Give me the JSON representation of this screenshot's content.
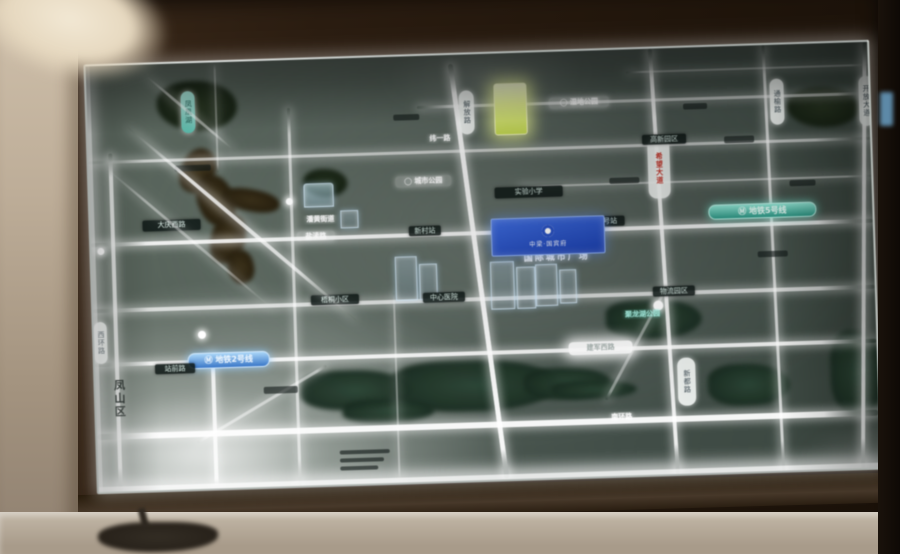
{
  "board": {
    "plaque": {
      "logo_name": "developer-ring-logo",
      "text": "中梁·国宾府"
    },
    "caption": "国际城市广场",
    "metro_badges": [
      {
        "name": "metro-line5-badge",
        "text": "Ⓜ 地铁5号线"
      },
      {
        "name": "metro-line2-badge",
        "text": "Ⓜ 地铁2号线"
      }
    ],
    "district_label": "凤山区",
    "features": [
      {
        "t": "wa",
        "n": "lake-northwest",
        "x": 36,
        "y": 2,
        "w": 146,
        "h": 88
      },
      {
        "t": "bl",
        "n": "lake-inner-patch",
        "x": 70,
        "y": 18,
        "w": 80,
        "h": 50
      },
      {
        "t": "riv",
        "n": "river-bend-1",
        "x": 92,
        "y": 85,
        "w": 34,
        "h": 46,
        "rot": 28
      },
      {
        "t": "riv",
        "n": "river-bend-2",
        "x": 108,
        "y": 112,
        "w": 36,
        "h": 52,
        "rot": -20
      },
      {
        "t": "riv",
        "n": "river-arm",
        "x": 132,
        "y": 128,
        "w": 58,
        "h": 22,
        "rot": 12
      },
      {
        "t": "riv",
        "n": "river-bend-3",
        "x": 120,
        "y": 152,
        "w": 34,
        "h": 50,
        "rot": 18
      },
      {
        "t": "riv",
        "n": "river-tail",
        "x": 136,
        "y": 188,
        "w": 26,
        "h": 34,
        "rot": -12
      },
      {
        "t": "wa",
        "n": "canal-west-1",
        "x": 24,
        "y": 198,
        "w": 56,
        "h": 34
      },
      {
        "t": "wa",
        "n": "canal-west-2",
        "x": 104,
        "y": 226,
        "w": 58,
        "h": 36
      },
      {
        "t": "wa2",
        "n": "river-south-1",
        "x": 204,
        "y": 312,
        "w": 112,
        "h": 40
      },
      {
        "t": "wa2",
        "n": "river-south-2",
        "x": 295,
        "y": 305,
        "w": 168,
        "h": 52
      },
      {
        "t": "wa2",
        "n": "river-south-3",
        "x": 428,
        "y": 316,
        "w": 88,
        "h": 32
      },
      {
        "t": "wa2",
        "n": "river-south-4",
        "x": 455,
        "y": 330,
        "w": 86,
        "h": 18
      },
      {
        "t": "wa2",
        "n": "river-south-5",
        "x": 246,
        "y": 342,
        "w": 92,
        "h": 24
      },
      {
        "t": "wa2",
        "n": "lake-east",
        "x": 512,
        "y": 250,
        "w": 96,
        "h": 40
      },
      {
        "t": "wa2",
        "n": "river-southeast",
        "x": 612,
        "y": 318,
        "w": 82,
        "h": 42
      },
      {
        "t": "wa2",
        "n": "river-east-edge",
        "x": 735,
        "y": 288,
        "w": 55,
        "h": 84
      },
      {
        "t": "bl",
        "n": "park-trees-northeast",
        "x": 700,
        "y": 44,
        "w": 72,
        "h": 40
      },
      {
        "t": "bl",
        "n": "park-patch-center",
        "x": 214,
        "y": 110,
        "w": 44,
        "h": 28
      },
      {
        "t": "rh",
        "n": "road-h-north",
        "x": 0,
        "y": 95,
        "w": 782,
        "h": 3,
        "op": 0.7
      },
      {
        "t": "rh",
        "n": "road-h-main",
        "x": 0,
        "y": 177,
        "w": 782,
        "h": 4,
        "op": 0.95
      },
      {
        "t": "rh",
        "n": "road-h-mid",
        "x": 0,
        "y": 243,
        "w": 782,
        "h": 4,
        "op": 0.8
      },
      {
        "t": "rh",
        "n": "road-h-jianjun",
        "x": 0,
        "y": 297,
        "w": 782,
        "h": 4,
        "op": 0.95
      },
      {
        "t": "rh",
        "n": "road-h-south",
        "x": 0,
        "y": 368,
        "w": 782,
        "h": 6,
        "op": 1
      },
      {
        "t": "rh",
        "n": "road-h-top-east",
        "x": 330,
        "y": 50,
        "w": 452,
        "h": 3,
        "op": 0.65
      },
      {
        "t": "rh",
        "n": "road-h-east-minor",
        "x": 430,
        "y": 133,
        "w": 352,
        "h": 2,
        "op": 0.55
      },
      {
        "t": "rh",
        "n": "road-h-top-edge",
        "x": 540,
        "y": 22,
        "w": 242,
        "h": 2,
        "op": 0.45
      },
      {
        "t": "rv",
        "n": "road-v-west",
        "x": 20,
        "y": 88,
        "w": 4,
        "h": 338,
        "op": 0.85
      },
      {
        "t": "rv",
        "n": "road-v-southwest",
        "x": 116,
        "y": 290,
        "w": 4,
        "h": 136,
        "op": 0.9
      },
      {
        "t": "rv",
        "n": "road-v-northwest-faint",
        "x": 128,
        "y": 0,
        "w": 2,
        "h": 110,
        "op": 0.4
      },
      {
        "t": "rv",
        "n": "road-v-left",
        "x": 200,
        "y": 48,
        "w": 3,
        "h": 378,
        "op": 0.7
      },
      {
        "t": "rv",
        "n": "road-v-center",
        "x": 384,
        "y": 8,
        "w": 5,
        "h": 418,
        "op": 1,
        "rot": -6
      },
      {
        "t": "rv",
        "n": "road-v-east-center",
        "x": 570,
        "y": 0,
        "w": 4,
        "h": 426,
        "op": 0.95,
        "rot": -2
      },
      {
        "t": "rv",
        "n": "road-v-east",
        "x": 680,
        "y": 0,
        "w": 3,
        "h": 426,
        "op": 0.8,
        "rot": -1
      },
      {
        "t": "rv",
        "n": "road-v-far-east",
        "x": 770,
        "y": 0,
        "w": 4,
        "h": 426,
        "op": 0.95,
        "rot": 2
      },
      {
        "t": "rv",
        "n": "road-v-minor",
        "x": 300,
        "y": 236,
        "w": 2,
        "h": 190,
        "op": 0.45
      },
      {
        "t": "rdg",
        "n": "road-diag-southwest",
        "x": 100,
        "y": 378,
        "w": 150,
        "h": 3,
        "rot": -29,
        "op": 0.6
      },
      {
        "t": "rdg",
        "n": "road-diag-southeast",
        "x": 510,
        "y": 348,
        "w": 135,
        "h": 3,
        "rot": -60,
        "op": 0.5
      },
      {
        "t": "bd",
        "n": "building-block-1",
        "x": 303,
        "y": 200,
        "w": 20,
        "h": 42
      },
      {
        "t": "bd",
        "n": "building-block-2",
        "x": 327,
        "y": 208,
        "w": 16,
        "h": 34
      },
      {
        "t": "bd",
        "n": "building-block-3",
        "x": 398,
        "y": 208,
        "w": 22,
        "h": 46
      },
      {
        "t": "bd",
        "n": "building-block-4",
        "x": 424,
        "y": 214,
        "w": 17,
        "h": 40
      },
      {
        "t": "bd",
        "n": "building-block-5",
        "x": 443,
        "y": 212,
        "w": 20,
        "h": 40
      },
      {
        "t": "bd",
        "n": "building-block-6",
        "x": 467,
        "y": 218,
        "w": 15,
        "h": 32
      },
      {
        "t": "bd",
        "n": "building-small",
        "x": 250,
        "y": 152,
        "w": 16,
        "h": 16
      },
      {
        "t": "bd",
        "n": "landmark-pale-building",
        "x": 214,
        "y": 124,
        "w": 28,
        "h": 22,
        "cls": "pale"
      },
      {
        "t": "vpill",
        "n": "lake-name-pill",
        "x": 94,
        "y": 28,
        "w": 14,
        "h": 42,
        "text": "凤凰湖",
        "cls": "teal"
      },
      {
        "t": "vdark",
        "n": "district-label",
        "x": 16,
        "y": 308,
        "w": 15,
        "h": 50,
        "text": "凤山区"
      },
      {
        "t": "tealbadge",
        "n": "metro-line5-badge",
        "x": 618,
        "y": 158,
        "w": 106,
        "h": 13,
        "text": "Ⓜ 地铁5号线"
      },
      {
        "t": "bluebadge",
        "n": "metro-line2-badge",
        "x": 93,
        "y": 290,
        "w": 80,
        "h": 14,
        "text": "Ⓜ 地铁2号线"
      },
      {
        "t": "caption",
        "n": "project-caption",
        "x": 402,
        "y": 200,
        "w": 126,
        "h": 12,
        "text": "国际城市广场"
      },
      {
        "t": "yellow",
        "n": "highlight-tower",
        "x": 407,
        "y": 30,
        "w": 31,
        "h": 50
      },
      {
        "t": "vpill",
        "n": "road-pill-red",
        "x": 559,
        "y": 90,
        "w": 22,
        "h": 60,
        "text": "希望大道",
        "cls": "red"
      },
      {
        "t": "vpill",
        "n": "road-pill-center",
        "x": 372,
        "y": 36,
        "w": 15,
        "h": 44,
        "text": "解放路"
      },
      {
        "t": "vpill",
        "n": "road-pill-tongyu",
        "x": 683,
        "y": 34,
        "w": 14,
        "h": 46,
        "text": "通榆路"
      },
      {
        "t": "vpill",
        "n": "road-pill-kaifang",
        "x": 772,
        "y": 34,
        "w": 14,
        "h": 50,
        "text": "开放大道"
      },
      {
        "t": "vpill",
        "n": "road-pill-xindu",
        "x": 582,
        "y": 310,
        "w": 18,
        "h": 48,
        "text": "新都路"
      },
      {
        "t": "vpill",
        "n": "road-pill-west",
        "x": 0,
        "y": 256,
        "w": 13,
        "h": 42,
        "text": "西环路"
      },
      {
        "t": "dk",
        "n": "poi-school",
        "x": 405,
        "y": 134,
        "w": 68,
        "h": 11,
        "text": "实验小学"
      },
      {
        "t": "gpill",
        "n": "road-label-yandu",
        "x": 206,
        "y": 172,
        "w": 38,
        "h": 10,
        "text": "盐渎路"
      },
      {
        "t": "dk",
        "n": "station-label-1",
        "x": 318,
        "y": 170,
        "w": 32,
        "h": 10,
        "text": "新村站"
      },
      {
        "t": "dk",
        "n": "station-label-2",
        "x": 498,
        "y": 166,
        "w": 36,
        "h": 10,
        "text": "一号站"
      },
      {
        "t": "gpill",
        "n": "poi-wetland-park",
        "x": 462,
        "y": 46,
        "w": 60,
        "h": 11,
        "text": "◯ 湿地公园"
      },
      {
        "t": "gpill",
        "n": "poi-city-park",
        "x": 306,
        "y": 120,
        "w": 56,
        "h": 11,
        "text": "◯ 城市公园"
      },
      {
        "t": "glow",
        "n": "road-label-weiyi",
        "x": 334,
        "y": 78,
        "w": 36,
        "h": 10,
        "text": "纬一路"
      },
      {
        "t": "tealtext",
        "n": "poi-lake-park",
        "x": 520,
        "y": 260,
        "w": 58,
        "h": 10,
        "text": "聚龙湖公园"
      },
      {
        "t": "hot",
        "n": "road-label-jianjun",
        "x": 474,
        "y": 291,
        "w": 64,
        "h": 13,
        "text": "建军西路"
      },
      {
        "t": "glow",
        "n": "road-label-south",
        "x": 502,
        "y": 362,
        "w": 46,
        "h": 11,
        "text": "南环路"
      },
      {
        "t": "dk",
        "n": "poi-block-1",
        "x": 218,
        "y": 236,
        "w": 48,
        "h": 10,
        "text": "梧桐小区"
      },
      {
        "t": "dk",
        "n": "poi-block-2",
        "x": 330,
        "y": 237,
        "w": 42,
        "h": 10,
        "text": "中心医院"
      },
      {
        "t": "glow",
        "n": "poi-street-office",
        "x": 208,
        "y": 156,
        "w": 44,
        "h": 9,
        "text": "潘黄街道"
      },
      {
        "t": "dk",
        "n": "poi-hightech",
        "x": 554,
        "y": 86,
        "w": 44,
        "h": 10,
        "text": "高新园区"
      },
      {
        "t": "dk",
        "n": "poi-logistics",
        "x": 560,
        "y": 238,
        "w": 42,
        "h": 10,
        "text": "物流园区"
      },
      {
        "t": "dk",
        "n": "road-label-daqing",
        "x": 52,
        "y": 156,
        "w": 58,
        "h": 11,
        "text": "大庆西路"
      },
      {
        "t": "dk",
        "n": "road-label-zhanqian",
        "x": 60,
        "y": 300,
        "w": 40,
        "h": 10,
        "text": "站前路"
      },
      {
        "t": "dot",
        "n": "station-dot-1",
        "x": 104,
        "y": 268,
        "w": 8,
        "h": 8
      },
      {
        "t": "dot",
        "n": "station-dot-2",
        "x": 6,
        "y": 182,
        "w": 7,
        "h": 7
      },
      {
        "t": "dot",
        "n": "station-dot-3",
        "x": 196,
        "y": 138,
        "w": 7,
        "h": 7
      },
      {
        "t": "dot",
        "n": "interchange-dot",
        "x": 560,
        "y": 252,
        "w": 10,
        "h": 10
      },
      {
        "t": "dash",
        "n": "minor-label",
        "x": 86,
        "y": 102,
        "w": 36,
        "h": 6
      },
      {
        "t": "dash",
        "n": "minor-label",
        "x": 636,
        "y": 90,
        "w": 30,
        "h": 7
      },
      {
        "t": "dash",
        "n": "minor-label",
        "x": 700,
        "y": 136,
        "w": 26,
        "h": 6
      },
      {
        "t": "dash",
        "n": "minor-label",
        "x": 596,
        "y": 56,
        "w": 24,
        "h": 6
      },
      {
        "t": "dash",
        "n": "minor-label",
        "x": 666,
        "y": 206,
        "w": 30,
        "h": 6
      },
      {
        "t": "dash",
        "n": "minor-label",
        "x": 168,
        "y": 326,
        "w": 34,
        "h": 7
      },
      {
        "t": "dash",
        "n": "legend-line",
        "x": 242,
        "y": 392,
        "w": 50,
        "h": 4
      },
      {
        "t": "dash",
        "n": "legend-line",
        "x": 242,
        "y": 400,
        "w": 44,
        "h": 4
      },
      {
        "t": "dash",
        "n": "legend-line",
        "x": 242,
        "y": 408,
        "w": 38,
        "h": 4
      },
      {
        "t": "dash",
        "n": "minor-label",
        "x": 306,
        "y": 58,
        "w": 26,
        "h": 6
      },
      {
        "t": "dash",
        "n": "minor-label",
        "x": 520,
        "y": 128,
        "w": 30,
        "h": 6
      },
      {
        "t": "st",
        "n": "glass-glare-streak-main",
        "x": 40,
        "y": 60,
        "w": 300,
        "h": 4,
        "rot": 42,
        "op": 0.9
      },
      {
        "t": "st",
        "n": "glass-glare-streak-faint",
        "x": 12,
        "y": 96,
        "w": 230,
        "h": 3,
        "rot": 42,
        "op": 0.5
      },
      {
        "t": "st",
        "n": "glass-glare-streak-top",
        "x": 58,
        "y": 8,
        "w": 120,
        "h": 3,
        "rot": 42,
        "op": 0.6
      },
      {
        "t": "gl",
        "n": "glare-bottom-left",
        "x": -30,
        "y": 330,
        "w": 260,
        "h": 120
      },
      {
        "t": "gl",
        "n": "glare-top-center",
        "x": 300,
        "y": -20,
        "w": 200,
        "h": 80,
        "op": 0.25
      },
      {
        "t": "gl",
        "n": "glare-bottom-right",
        "x": 700,
        "y": 380,
        "w": 140,
        "h": 70,
        "op": 0.3
      }
    ]
  },
  "colors": {
    "road_glow": "#ffffff",
    "water_teal": "#2e5f55",
    "metro_line5": "#2e9a88",
    "metro_line2": "#3a78c8",
    "plaque_blue": "#1b3fae",
    "highlight_yellow": "#cadf55",
    "wall_beige": "#b6a692",
    "frame_brown": "#2b1d11"
  }
}
